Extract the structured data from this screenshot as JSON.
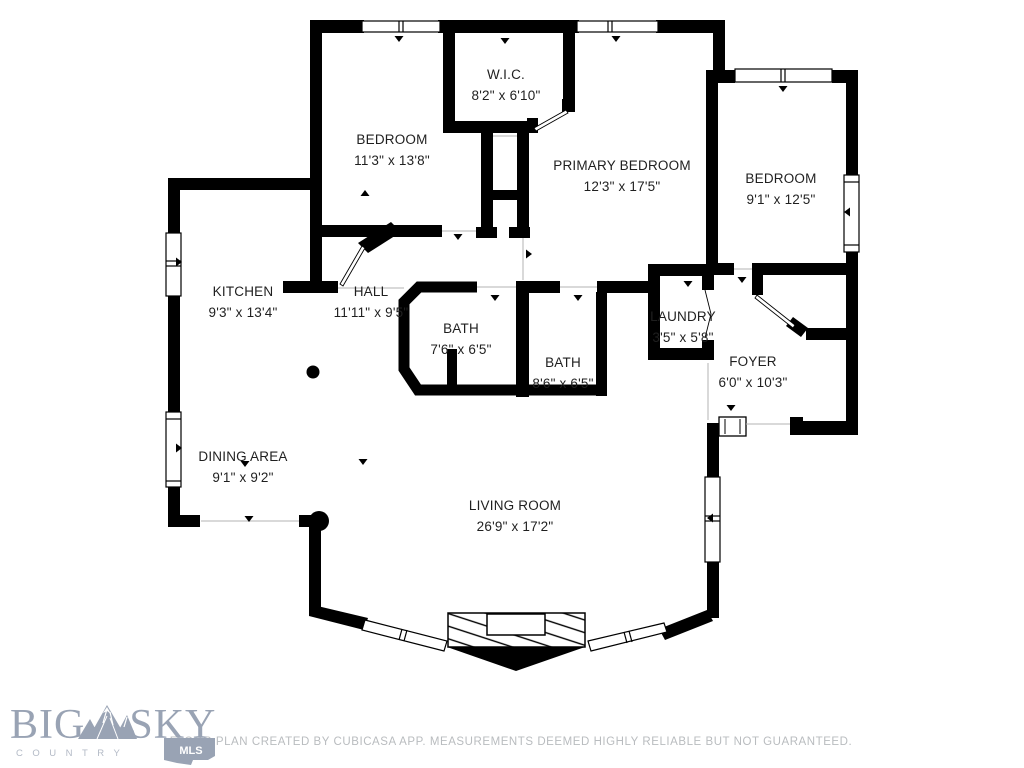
{
  "rooms": [
    {
      "id": "wic",
      "name": "W.I.C.",
      "dims": "8'2\" x 6'10\""
    },
    {
      "id": "bedroom-1",
      "name": "BEDROOM",
      "dims": "11'3\" x 13'8\""
    },
    {
      "id": "primary-bedroom",
      "name": "PRIMARY BEDROOM",
      "dims": "12'3\" x 17'5\""
    },
    {
      "id": "bedroom-2",
      "name": "BEDROOM",
      "dims": "9'1\" x 12'5\""
    },
    {
      "id": "kitchen",
      "name": "KITCHEN",
      "dims": "9'3\" x 13'4\""
    },
    {
      "id": "hall",
      "name": "HALL",
      "dims": "11'11\" x 9'5\""
    },
    {
      "id": "bath-1",
      "name": "BATH",
      "dims": "7'6\" x 6'5\""
    },
    {
      "id": "bath-2",
      "name": "BATH",
      "dims": "8'6\" x 6'5\""
    },
    {
      "id": "laundry",
      "name": "LAUNDRY",
      "dims": "3'5\" x 5'8\""
    },
    {
      "id": "foyer",
      "name": "FOYER",
      "dims": "6'0\" x 10'3\""
    },
    {
      "id": "dining-area",
      "name": "DINING AREA",
      "dims": "9'1\" x 9'2\""
    },
    {
      "id": "living-room",
      "name": "LIVING ROOM",
      "dims": "26'9\" x 17'2\""
    }
  ],
  "footer": {
    "disclaimer": "FLOOR PLAN CREATED BY CUBICASA APP. MEASUREMENTS DEEMED HIGHLY RELIABLE BUT NOT GUARANTEED."
  },
  "logo": {
    "brand_left": "BIG",
    "brand_right": "SKY",
    "tagline": "COUNTRY",
    "badge": "MLS"
  },
  "colors": {
    "wall": "#000000",
    "label_text": "#1f1f1f",
    "opening_line": "#b3b3b3",
    "footer_text": "#b9bcbf",
    "logo": "#99a3b4",
    "logo_tagline": "#b3bac6",
    "badge_text": "#ffffff"
  }
}
